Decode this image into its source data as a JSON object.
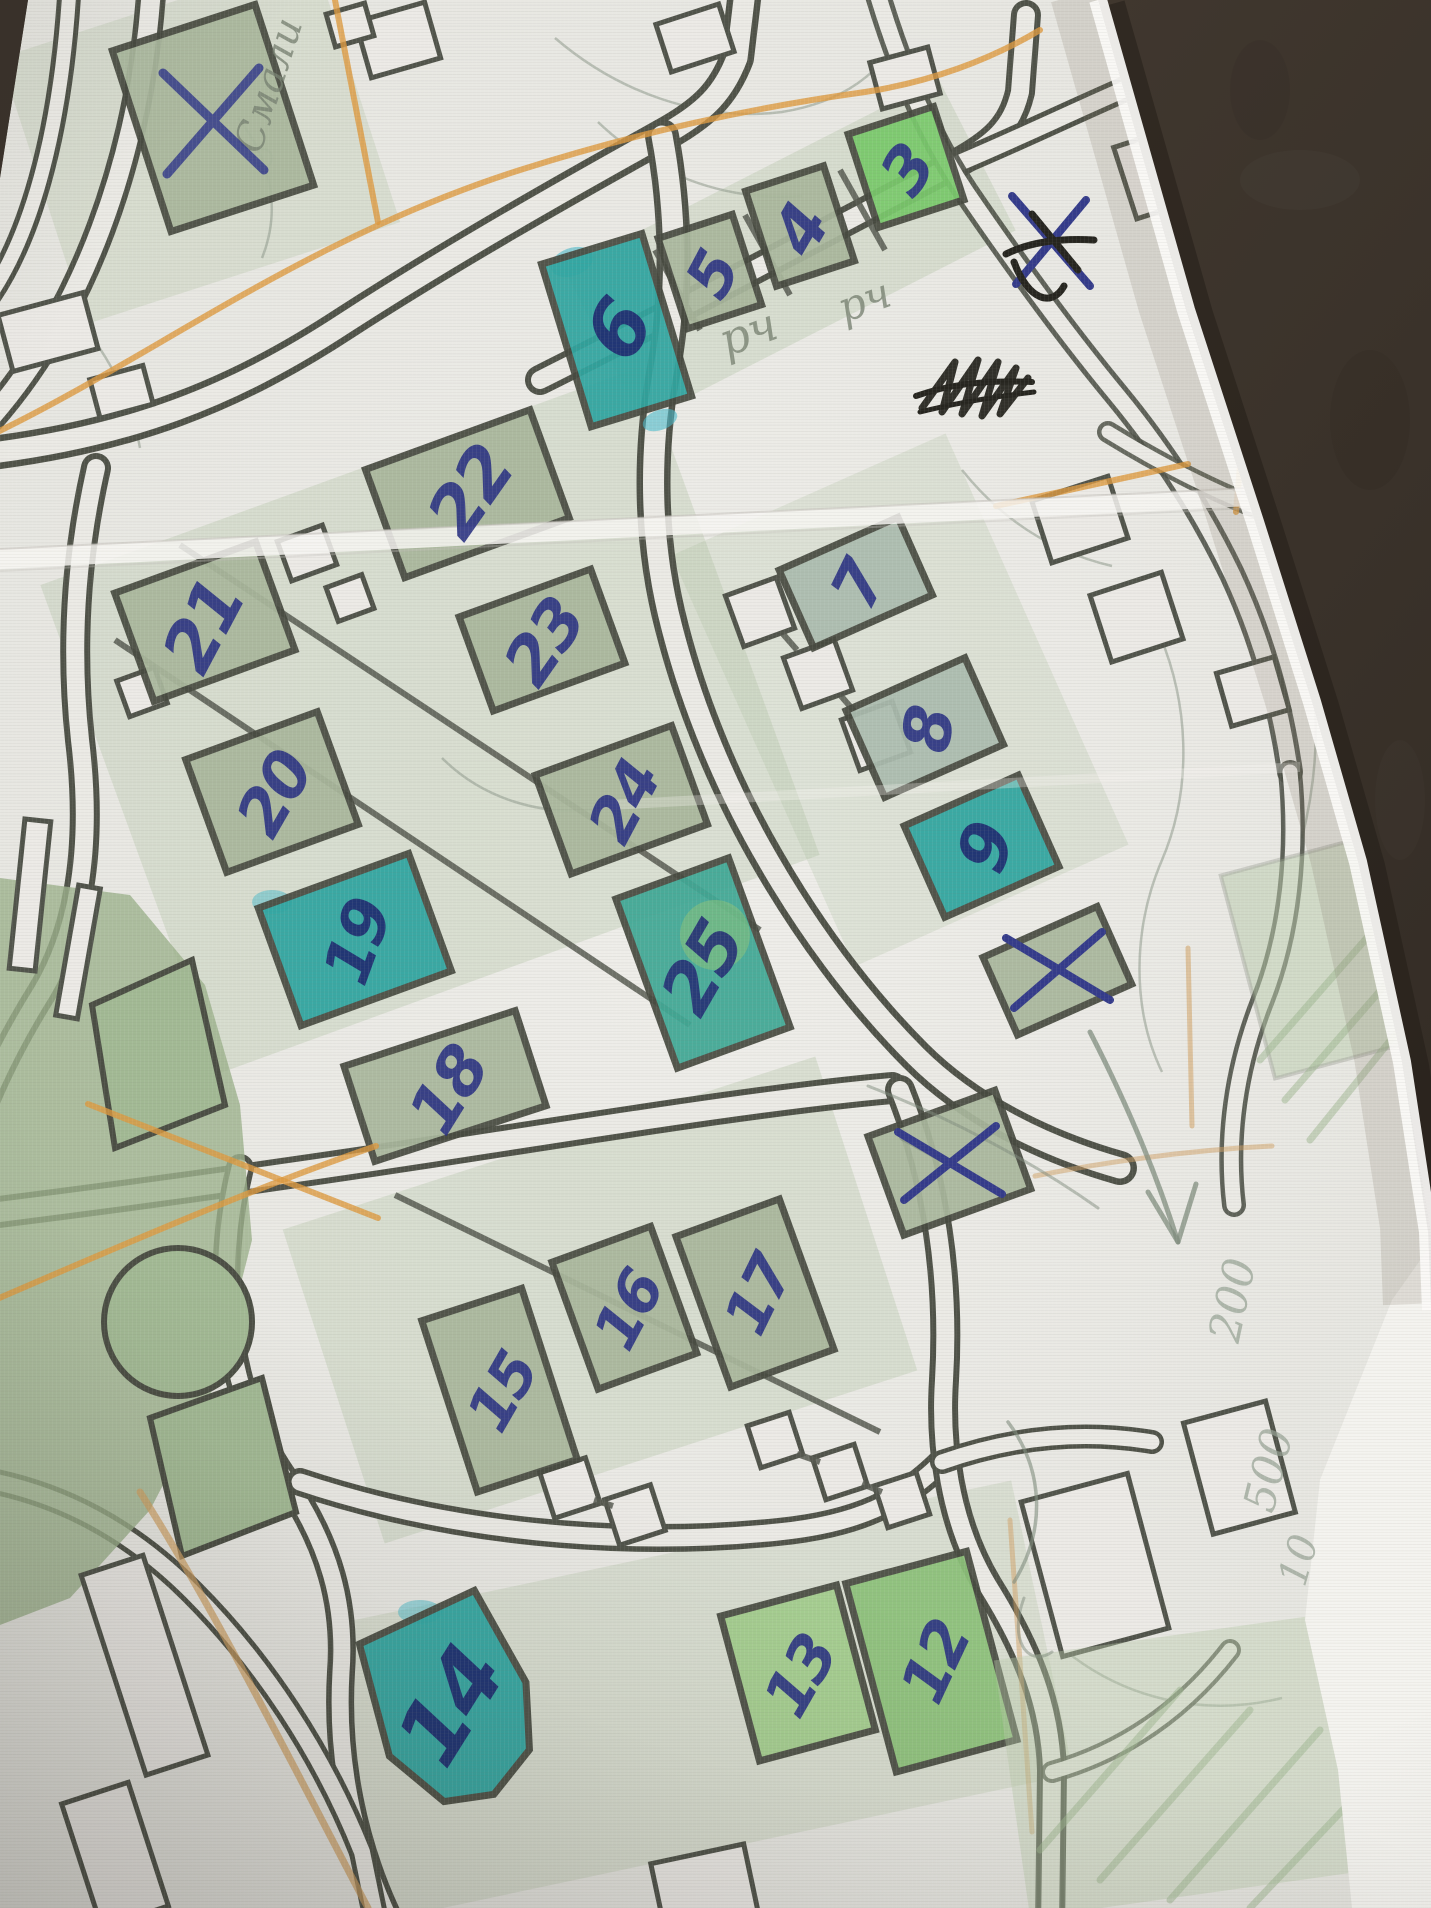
{
  "scene": {
    "description": "photo of a printed street map on a dark leather surface, hand-annotated in blue ballpoint pen and coloured pencil",
    "surface_color": "#3a3229",
    "paper_color": "#e9e9e4"
  },
  "map": {
    "building_numbers": [
      "3",
      "4",
      "5",
      "6",
      "7",
      "8",
      "9",
      "12",
      "13",
      "14",
      "15",
      "16",
      "17",
      "18",
      "19",
      "20",
      "21",
      "22",
      "23",
      "24",
      "25"
    ],
    "numbers": [
      {
        "id": "3",
        "label": "3",
        "x": 907,
        "y": 170,
        "rot": -55,
        "size": 64
      },
      {
        "id": "4",
        "label": "4",
        "x": 800,
        "y": 230,
        "rot": -60,
        "size": 66
      },
      {
        "id": "5",
        "label": "5",
        "x": 712,
        "y": 275,
        "rot": -62,
        "size": 62
      },
      {
        "id": "6",
        "label": "6",
        "x": 618,
        "y": 330,
        "rot": -60,
        "size": 78,
        "color": "#1f2a70"
      },
      {
        "id": "7",
        "label": "7",
        "x": 858,
        "y": 585,
        "rot": -64,
        "size": 64
      },
      {
        "id": "8",
        "label": "8",
        "x": 928,
        "y": 730,
        "rot": -80,
        "size": 66
      },
      {
        "id": "9",
        "label": "9",
        "x": 985,
        "y": 848,
        "rot": -70,
        "size": 68,
        "color": "#1f2a70"
      },
      {
        "id": "12",
        "label": "12",
        "x": 935,
        "y": 1662,
        "rot": -65,
        "size": 62
      },
      {
        "id": "13",
        "label": "13",
        "x": 800,
        "y": 1676,
        "rot": -60,
        "size": 62
      },
      {
        "id": "14",
        "label": "14",
        "x": 450,
        "y": 1706,
        "rot": -58,
        "size": 88,
        "color": "#1f2a70"
      },
      {
        "id": "15",
        "label": "15",
        "x": 502,
        "y": 1392,
        "rot": -60,
        "size": 60
      },
      {
        "id": "16",
        "label": "16",
        "x": 628,
        "y": 1310,
        "rot": -62,
        "size": 60
      },
      {
        "id": "17",
        "label": "17",
        "x": 758,
        "y": 1295,
        "rot": -64,
        "size": 60
      },
      {
        "id": "18",
        "label": "18",
        "x": 448,
        "y": 1090,
        "rot": -58,
        "size": 66
      },
      {
        "id": "19",
        "label": "19",
        "x": 357,
        "y": 942,
        "rot": -70,
        "size": 64,
        "color": "#1f2a70"
      },
      {
        "id": "20",
        "label": "20",
        "x": 274,
        "y": 794,
        "rot": -60,
        "size": 64
      },
      {
        "id": "21",
        "label": "21",
        "x": 203,
        "y": 626,
        "rot": -62,
        "size": 70
      },
      {
        "id": "22",
        "label": "22",
        "x": 470,
        "y": 492,
        "rot": -55,
        "size": 70
      },
      {
        "id": "23",
        "label": "23",
        "x": 544,
        "y": 642,
        "rot": -55,
        "size": 66
      },
      {
        "id": "24",
        "label": "24",
        "x": 624,
        "y": 802,
        "rot": -62,
        "size": 62
      },
      {
        "id": "25",
        "label": "25",
        "x": 702,
        "y": 968,
        "rot": -60,
        "size": 70,
        "color": "#253075"
      }
    ],
    "teal_highlighted_buildings": [
      "6",
      "9",
      "14",
      "19",
      "25"
    ],
    "bright_green_buildings": [
      "3",
      "12",
      "13"
    ],
    "x_marked_spots": [
      "top-left building",
      "building below 9",
      "building lower right-middle",
      "paper edge X crossed out in black"
    ],
    "colors": {
      "ink": "#2c3383",
      "teal": "#2fa5a0",
      "sage_green": "#a9b79c",
      "bright_green": "#79c96b",
      "outline": "#474a40",
      "orange_pencil": "#dd9a40",
      "road_fill": "#ebeae5"
    }
  },
  "annotations": {
    "pencil_texts": [
      {
        "id": "street-name",
        "text": "Смали",
        "x": 268,
        "y": 85,
        "rot": -72,
        "size": 40,
        "cls": "pencil-script"
      },
      {
        "id": "note-1",
        "text": "рч",
        "x": 748,
        "y": 332,
        "rot": -20,
        "size": 46,
        "cls": "pencil-script"
      },
      {
        "id": "note-2",
        "text": "рч",
        "x": 864,
        "y": 300,
        "rot": -20,
        "size": 42,
        "cls": "pencil-script"
      },
      {
        "id": "dist-200",
        "text": "200",
        "x": 1232,
        "y": 1300,
        "rot": -78,
        "size": 44,
        "cls": "pencil-faint"
      },
      {
        "id": "dist-500",
        "text": "500",
        "x": 1268,
        "y": 1470,
        "rot": -76,
        "size": 44,
        "cls": "pencil-faint"
      },
      {
        "id": "dist-10",
        "text": "10",
        "x": 1298,
        "y": 1560,
        "rot": -74,
        "size": 40,
        "cls": "pencil-faint"
      }
    ],
    "black_scribble": "illegible scribbled-out word",
    "crossed_out_x": "blue X near paper edge crossed out in black pen"
  }
}
